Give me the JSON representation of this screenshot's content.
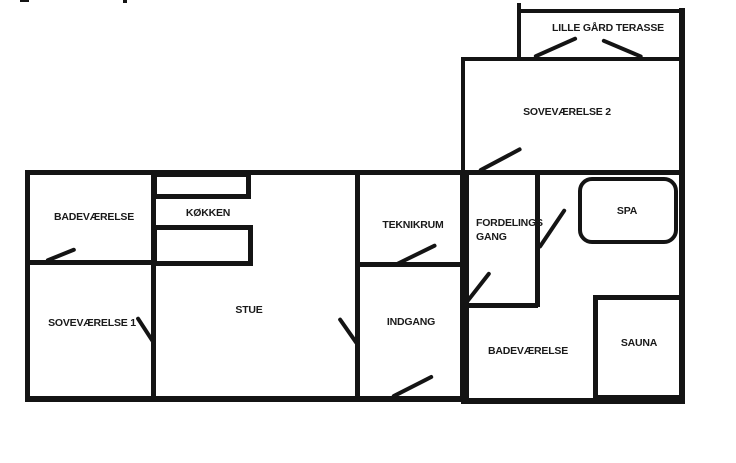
{
  "diagram": {
    "type": "floor-plan",
    "ink_color": "#141414",
    "background_color": "#ffffff",
    "rooms": {
      "terrace": "LILLE GÅRD TERASSE",
      "bedroom2": "SOVEVÆRELSE 2",
      "bathroom1": "BADEVÆRELSE",
      "kitchen": "KØKKEN",
      "technical_room": "TEKNIKRUM",
      "distribution_hall": "FORDELINGS GANG",
      "spa": "SPA",
      "bedroom1": "SOVEVÆRELSE 1",
      "living_room": "STUE",
      "entrance": "INDGANG",
      "bathroom2": "BADEVÆRELSE",
      "sauna": "SAUNA"
    }
  }
}
